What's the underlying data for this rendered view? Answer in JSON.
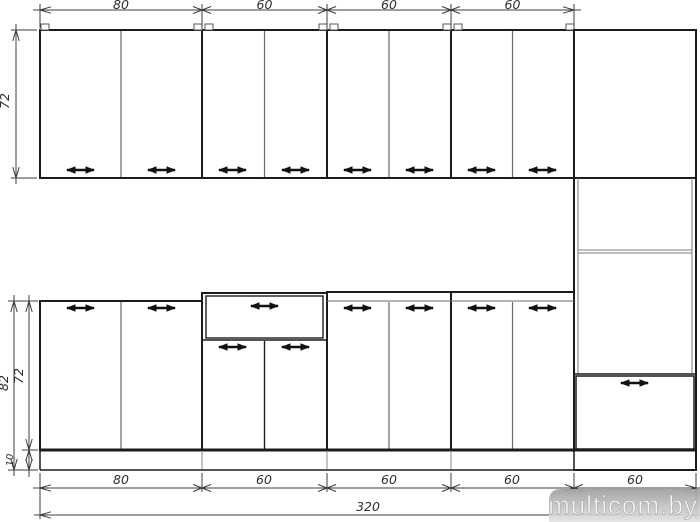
{
  "drawing": {
    "type_note": "kitchen elevation drawing",
    "dims": {
      "top": [
        "80",
        "60",
        "60",
        "60"
      ],
      "wall_height": "72",
      "base_overall_height": "82",
      "base_body_height": "72",
      "plinth_height": "10",
      "bottom": [
        "80",
        "60",
        "60",
        "60",
        "60"
      ],
      "total_width": "320"
    },
    "line_color": "#1c1c1c",
    "dim_color": "#3c3c3c"
  },
  "watermark": {
    "text": "multicom.by",
    "band_color": "#a0a0a0"
  }
}
